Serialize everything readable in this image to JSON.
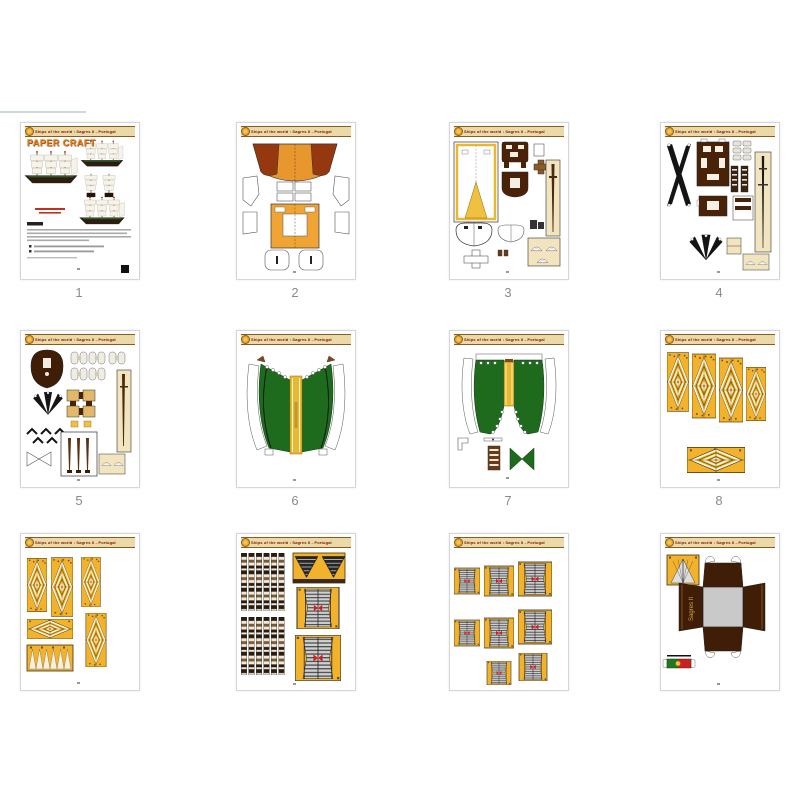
{
  "header": {
    "title": "Ships of the world : Sagres II - Portugal",
    "emblem_icon": "sun-emblem-icon"
  },
  "cover": {
    "logo": "PAPER CRAFT"
  },
  "stand": {
    "label": "Sagres II"
  },
  "page_numbers": [
    "1",
    "2",
    "3",
    "4",
    "5",
    "6",
    "7",
    "8"
  ],
  "colors": {
    "sail_yellow": "#f3b22b",
    "hull_orange": "#f0a433",
    "dark_brown": "#3f1d06",
    "panel_green": "#1e6b1e",
    "stripe_gold": "#e8b830",
    "header_tan": "#ecd9a8",
    "header_text_red": "#7a1408",
    "flag_green": "#1d7a1d",
    "flag_red": "#cc2020",
    "page_number_gray": "#8a8a8a"
  }
}
